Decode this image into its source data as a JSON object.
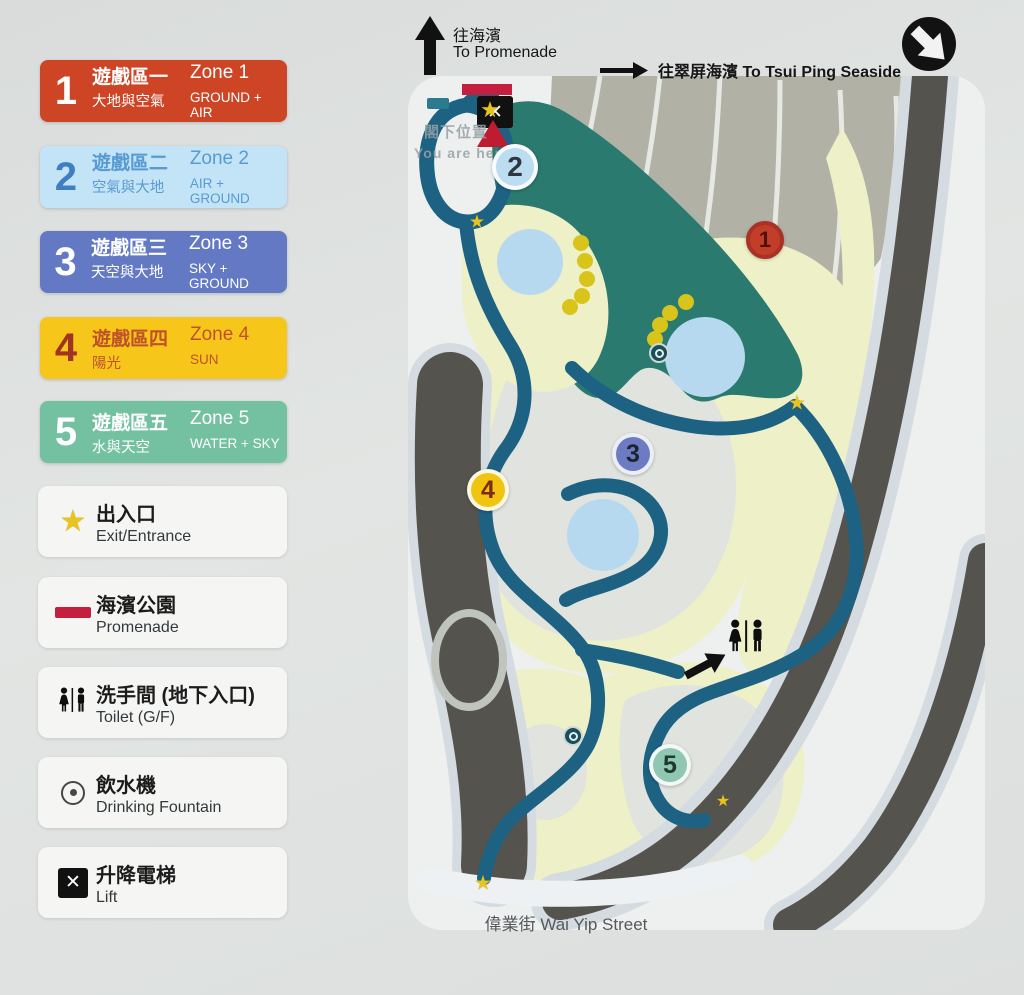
{
  "header": {
    "to_promenade_zh": "往海濱",
    "to_promenade_en": "To Promenade",
    "to_seaside": "往翠屏海濱 To Tsui Ping Seaside"
  },
  "legend": {
    "zones": [
      {
        "number": "1",
        "zh": "遊戲區一",
        "en": "Zone 1",
        "sub_zh": "大地與空氣",
        "sub_en": "GROUND + AIR",
        "bg": "#ce4526",
        "fg": "#ffffff",
        "num": "#ffffff"
      },
      {
        "number": "2",
        "zh": "遊戲區二",
        "en": "Zone 2",
        "sub_zh": "空氣與大地",
        "sub_en": "AIR + GROUND",
        "bg": "#c3e3f6",
        "fg": "#589bd2",
        "num": "#3f7fc1"
      },
      {
        "number": "3",
        "zh": "遊戲區三",
        "en": "Zone 3",
        "sub_zh": "天空與大地",
        "sub_en": "SKY + GROUND",
        "bg": "#6379c4",
        "fg": "#ffffff",
        "num": "#ffffff"
      },
      {
        "number": "4",
        "zh": "遊戲區四",
        "en": "Zone 4",
        "sub_zh": "陽光",
        "sub_en": "SUN",
        "bg": "#f6c71a",
        "fg": "#c0512a",
        "num": "#a03322"
      },
      {
        "number": "5",
        "zh": "遊戲區五",
        "en": "Zone 5",
        "sub_zh": "水與天空",
        "sub_en": "WATER + SKY",
        "bg": "#74c1a2",
        "fg": "#ffffff",
        "num": "#ffffff"
      }
    ],
    "items": [
      {
        "icon": "star-icon",
        "zh": "出入口",
        "en": "Exit/Entrance"
      },
      {
        "icon": "promenade-icon",
        "zh": "海濱公園",
        "en": "Promenade"
      },
      {
        "icon": "toilet-icon",
        "zh": "洗手間 (地下入口)",
        "en": "Toilet (G/F)"
      },
      {
        "icon": "fountain-icon",
        "zh": "飲水機",
        "en": "Drinking Fountain"
      },
      {
        "icon": "lift-icon",
        "zh": "升降電梯",
        "en": "Lift"
      }
    ]
  },
  "map": {
    "you_are_here_zh": "閣下位置",
    "you_are_here_en": "You are here",
    "street": "偉業街 Wai Yip Street",
    "markers": [
      {
        "number": "1",
        "bg": "#c23e28",
        "fg": "#4f1209"
      },
      {
        "number": "2",
        "bg": "#bcdcf2",
        "fg": "#2e3740"
      },
      {
        "number": "3",
        "bg": "#6d7cc2",
        "fg": "#1b2230"
      },
      {
        "number": "4",
        "bg": "#f1c40f",
        "fg": "#7e2a1a"
      },
      {
        "number": "5",
        "bg": "#8fc7b3",
        "fg": "#1f3830"
      }
    ]
  },
  "colors": {
    "page_bg": "#dfe2e0",
    "panel_bg": "#edf0ef",
    "path": "#1d6282",
    "zone_area": "#2a7a70",
    "road": "#55534d",
    "play_area": "#eef0c8",
    "water": "#b7d9ef",
    "terrace": "#b2b1a5",
    "star": "#e7c41f",
    "promenade_red": "#c51f3f"
  }
}
